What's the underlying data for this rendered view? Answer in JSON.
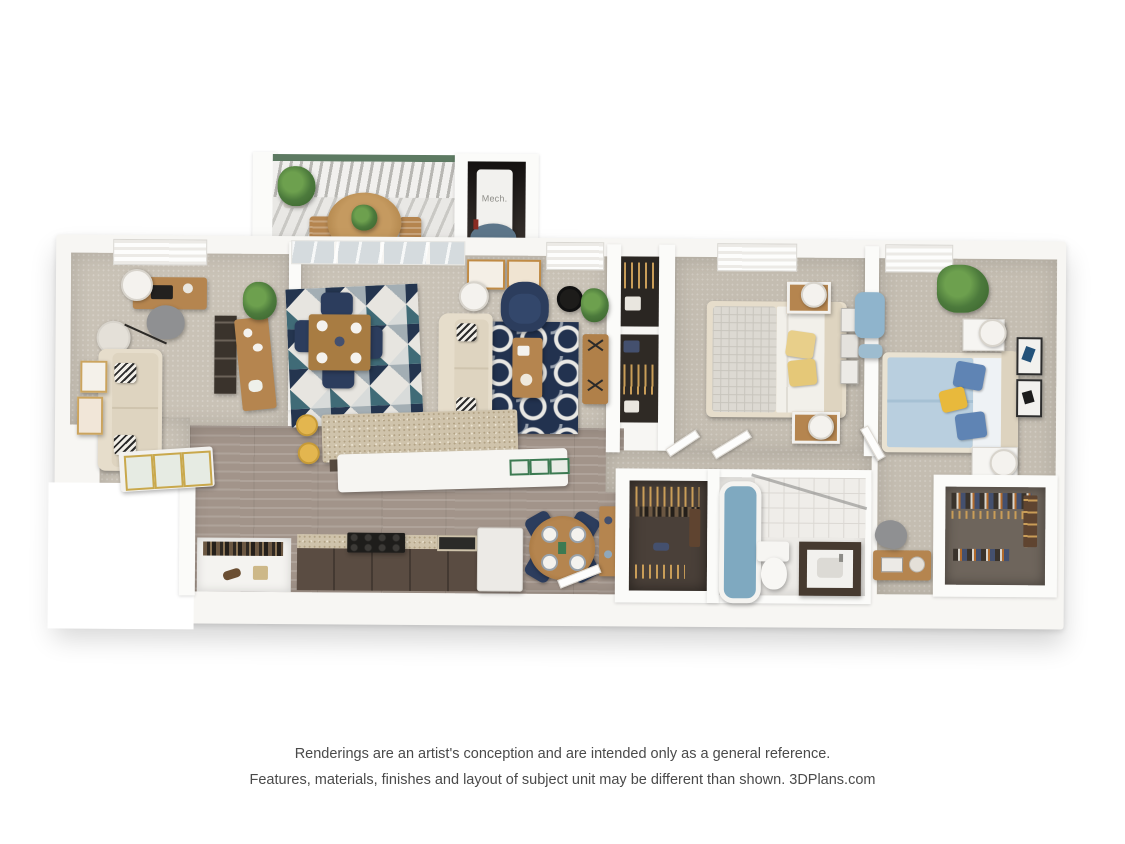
{
  "meta": {
    "type": "3d-floor-plan-rendering",
    "view": "top-down dollhouse"
  },
  "labels": {
    "mech": "Mech."
  },
  "disclaimer": {
    "line1": "Renderings are an artist's conception and are intended only as a general reference.",
    "line2": "Features, materials, finishes and layout of subject unit may be different than shown. 3DPlans.com"
  },
  "palette": {
    "background": "#ffffff",
    "wall_white": "#fbfbf9",
    "carpet_beige": "#c9c2b6",
    "wood_floor": "#a2948a",
    "closet_floor_dark": "#4a4039",
    "navy_accent": "#24354f",
    "teal_accent": "#406b77",
    "cream_sofa": "#e6ddcb",
    "yellow_accent": "#e3b64f",
    "light_blue_bedding": "#b9cfdf",
    "tub_blue": "#7fa9c0",
    "plant_green": "#4c7a3c",
    "wood_furniture": "#b5854f",
    "granite_counter": "#cfc3ab",
    "cabinet_brown": "#5a4c42",
    "balcony_rail_green": "#5d7a62",
    "disclaimer_text": "#4a4a4a"
  },
  "scene": {
    "balcony": [
      "railing",
      "potted-plant",
      "bistro-table",
      "patio-chair",
      "patio-chair"
    ],
    "mechanical_closet": [
      "water-heater",
      "tank"
    ],
    "office_den": [
      "window",
      "desk",
      "desk-chair",
      "pendant-lamp",
      "floor-lamp",
      "loveseat",
      "throw-pillows",
      "wall-art",
      "ladder-shelf",
      "sideboard",
      "potted-plant"
    ],
    "living_dining": [
      "sliding-glass-door",
      "dining-table",
      "dining-chairs",
      "triangle-rug",
      "sofa",
      "accent-armchair",
      "side-table",
      "table-lamp",
      "navy-pattern-rug",
      "coffee-table",
      "media-console",
      "wall-art",
      "wall-clock",
      "window",
      "potted-plant"
    ],
    "kitchen": [
      "granite-island",
      "breakfast-bar",
      "bar-stools",
      "serving-trays",
      "range",
      "base-cabinets",
      "refrigerator",
      "pantry-closet"
    ],
    "entry": [
      "round-breakfast-table",
      "dining-chairs",
      "console-table",
      "glass-console",
      "front-door"
    ],
    "hallway": [
      "linen-closets",
      "doors"
    ],
    "bedroom_1": [
      "window",
      "bed",
      "patterned-blanket",
      "yellow-pillows",
      "nightstands",
      "table-lamps",
      "wall-art",
      "closet-bays"
    ],
    "hall_bathroom": [
      "bathtub",
      "tile-wall",
      "toilet",
      "vanity",
      "walk-in-closet"
    ],
    "bedroom_2": [
      "window",
      "bed",
      "blue-pillows",
      "yellow-pillow",
      "nightstands",
      "table-lamps",
      "palm-plant",
      "wall-art",
      "lounge-chair",
      "desk",
      "desk-chair",
      "walk-in-closet"
    ]
  }
}
